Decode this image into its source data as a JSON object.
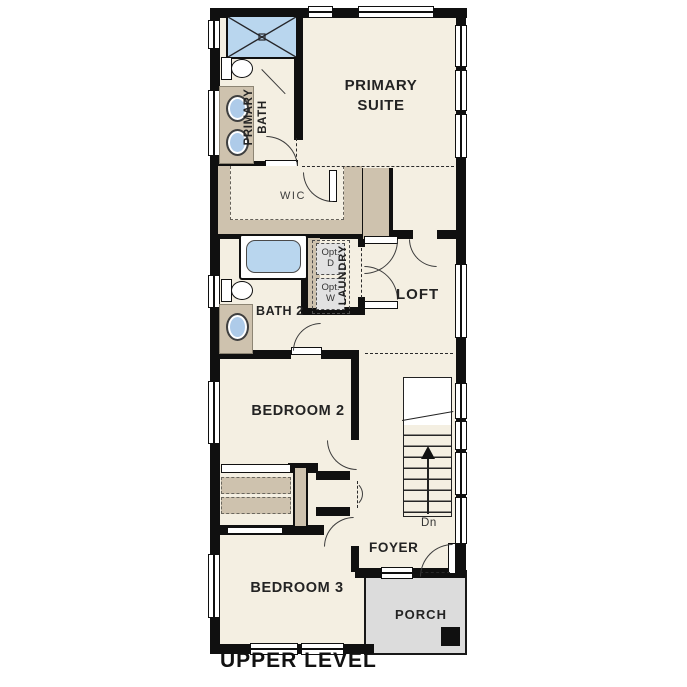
{
  "title": "UPPER LEVEL",
  "colors": {
    "wall": "#101010",
    "floor": "#f4efe2",
    "cabinet_tan": "#cec2ae",
    "fixture_blue": "#aecbe9",
    "porch_gray": "#dcdcdc",
    "appliance_gray": "#e2e2e2",
    "label": "#232323"
  },
  "rooms": {
    "primary_suite": {
      "label": "PRIMARY SUITE"
    },
    "primary_bath": {
      "label": "PRIMARY BATH"
    },
    "wic": {
      "label": "WIC"
    },
    "laundry": {
      "label": "LAUNDRY"
    },
    "loft": {
      "label": "LOFT"
    },
    "bath2": {
      "label": "BATH 2"
    },
    "bedroom2": {
      "label": "BEDROOM 2"
    },
    "bedroom3": {
      "label": "BEDROOM 3"
    },
    "foyer": {
      "label": "FOYER"
    },
    "porch": {
      "label": "PORCH"
    }
  },
  "laundry_options": {
    "dryer": {
      "l1": "Opt.",
      "l2": "D"
    },
    "washer": {
      "l1": "Opt.",
      "l2": "W"
    }
  },
  "stairs": {
    "direction": "Dn"
  },
  "fixtures": {
    "shower": "shower-fixture",
    "tub": "bathtub-fixture",
    "toilets": "toilet-fixture",
    "sinks": "sink-fixture"
  }
}
